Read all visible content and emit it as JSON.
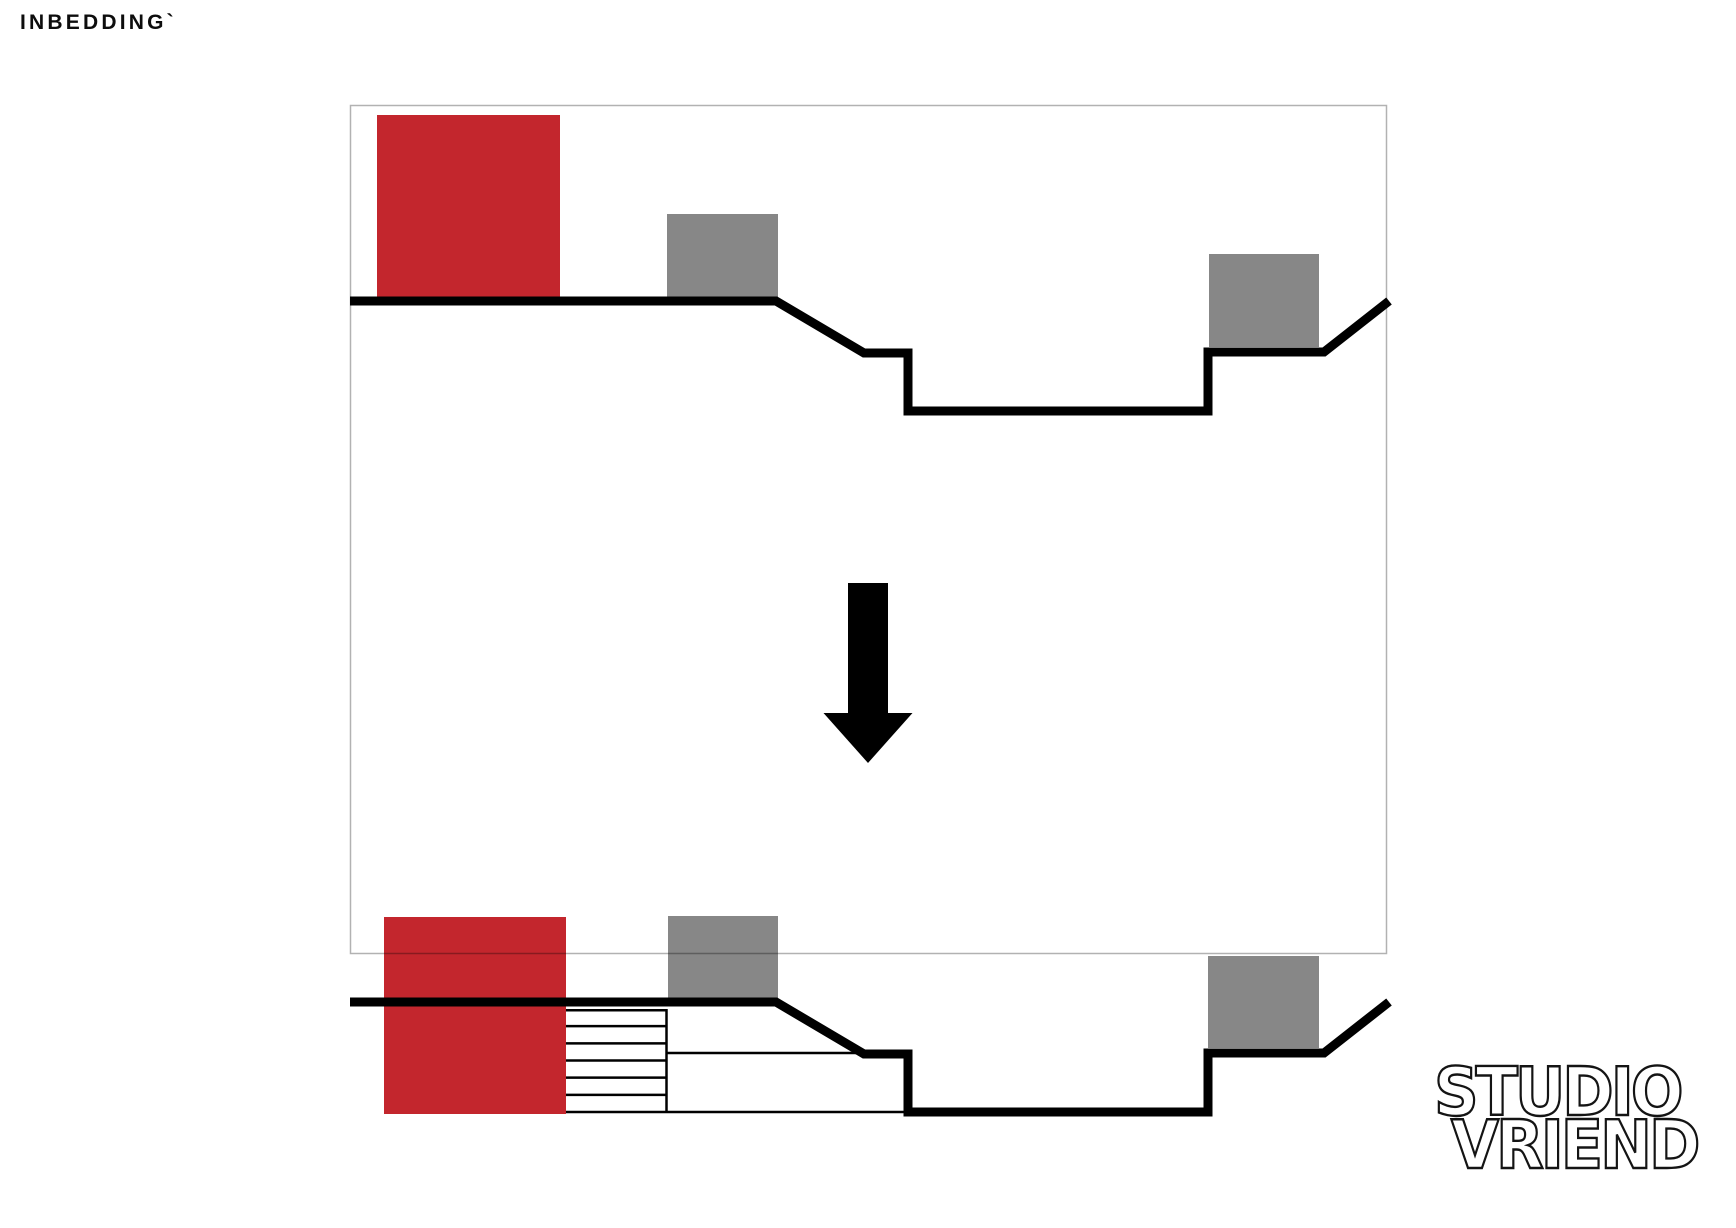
{
  "title": "INBEDDING`",
  "logo": {
    "line1": "STUDIO",
    "line2": "VRIEND"
  },
  "colors": {
    "red": "#c3262d",
    "gray": "#878787",
    "line": "#000000",
    "frame_stroke": "rgba(0,0,0,0.30)"
  },
  "frame": {
    "x": 350,
    "y": 105,
    "w": 1036,
    "h": 848
  },
  "terrain": {
    "stroke_width": 9,
    "before_path": [
      [
        350,
        301
      ],
      [
        776,
        301
      ],
      [
        864,
        353
      ],
      [
        908,
        353
      ],
      [
        908,
        411
      ],
      [
        1208,
        411
      ],
      [
        1208,
        352
      ],
      [
        1324,
        352
      ],
      [
        1389,
        301
      ]
    ],
    "after_offset_y": 701
  },
  "blocks": {
    "before": [
      {
        "name": "tall-building-block",
        "color": "red",
        "x": 377,
        "y": 115,
        "w": 183,
        "h": 182
      },
      {
        "name": "neighbor-block-left",
        "color": "gray",
        "x": 667,
        "y": 214,
        "w": 111,
        "h": 83
      },
      {
        "name": "neighbor-block-right",
        "color": "gray",
        "x": 1209,
        "y": 254,
        "w": 110,
        "h": 93
      }
    ],
    "after": [
      {
        "name": "embedded-building-block",
        "color": "red",
        "x": 384,
        "y": 917,
        "w": 182,
        "h": 197
      },
      {
        "name": "neighbor-block-left",
        "color": "gray",
        "x": 668,
        "y": 916,
        "w": 110,
        "h": 84
      },
      {
        "name": "neighbor-block-right",
        "color": "gray",
        "x": 1208,
        "y": 956,
        "w": 111,
        "h": 92
      }
    ]
  },
  "underground": {
    "stroke_width": 2.5,
    "hatch_box": {
      "x": 566,
      "y": 1009,
      "w": 101,
      "h": 103,
      "rows": 6
    },
    "wall_line": {
      "x": 666.5,
      "y1": 1009,
      "y2": 1112
    },
    "divider_line": {
      "x1": 667,
      "y": 1053,
      "x2": 866
    },
    "floor_line": {
      "x1": 566,
      "y": 1112,
      "x2": 907
    }
  },
  "arrow": {
    "cx": 868,
    "shaft_top": 583,
    "shaft_bottom": 713,
    "shaft_w": 40,
    "head_w": 89,
    "tip_y": 763
  }
}
